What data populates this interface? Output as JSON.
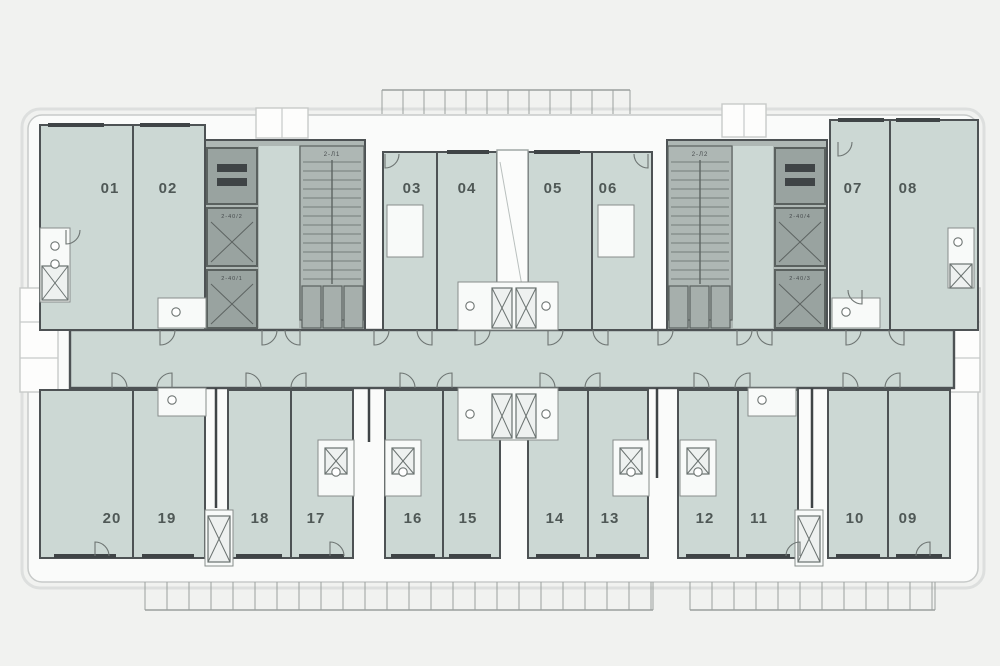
{
  "plan": {
    "name": "residential-floor-plan",
    "canvas": {
      "w": 1000,
      "h": 666
    },
    "colors": {
      "bg": "#f1f2f0",
      "paper": "#fafbfa",
      "outline": "#c7cac9",
      "trim": "#dddfde",
      "room": "#ccd8d4",
      "wall": "#4d5254",
      "core": "#aeb7b4",
      "coreCell": "#99a3a0",
      "coreEdge": "#5a615f",
      "dark": "#3f4446",
      "fixture": "#6d7472",
      "pod": "#f8faf9",
      "tick": "#9aa09e",
      "label": "#4f5856",
      "tinyLabel": "#454a4c"
    },
    "units_top": [
      {
        "label": "01",
        "x": 40,
        "y": 125,
        "w": 93,
        "h": 205,
        "lx": 110,
        "ly": 193
      },
      {
        "label": "02",
        "x": 133,
        "y": 125,
        "w": 72,
        "h": 205,
        "lx": 168,
        "ly": 193
      },
      {
        "label": "03",
        "x": 383,
        "y": 152,
        "w": 54,
        "h": 178,
        "lx": 412,
        "ly": 193
      },
      {
        "label": "04",
        "x": 437,
        "y": 152,
        "w": 60,
        "h": 178,
        "lx": 467,
        "ly": 193
      },
      {
        "label": "05",
        "x": 528,
        "y": 152,
        "w": 64,
        "h": 178,
        "lx": 553,
        "ly": 193
      },
      {
        "label": "06",
        "x": 592,
        "y": 152,
        "w": 60,
        "h": 178,
        "lx": 608,
        "ly": 193
      },
      {
        "label": "07",
        "x": 830,
        "y": 120,
        "w": 60,
        "h": 210,
        "lx": 853,
        "ly": 193
      },
      {
        "label": "08",
        "x": 890,
        "y": 120,
        "w": 88,
        "h": 210,
        "lx": 908,
        "ly": 193
      }
    ],
    "units_bottom": [
      {
        "label": "20",
        "x": 40,
        "y": 390,
        "w": 93,
        "h": 168,
        "lx": 112,
        "ly": 523
      },
      {
        "label": "19",
        "x": 133,
        "y": 390,
        "w": 72,
        "h": 168,
        "lx": 167,
        "ly": 523
      },
      {
        "label": "18",
        "x": 228,
        "y": 390,
        "w": 63,
        "h": 168,
        "lx": 260,
        "ly": 523
      },
      {
        "label": "17",
        "x": 291,
        "y": 390,
        "w": 62,
        "h": 168,
        "lx": 316,
        "ly": 523
      },
      {
        "label": "16",
        "x": 385,
        "y": 390,
        "w": 58,
        "h": 168,
        "lx": 413,
        "ly": 523
      },
      {
        "label": "15",
        "x": 443,
        "y": 390,
        "w": 57,
        "h": 168,
        "lx": 468,
        "ly": 523
      },
      {
        "label": "14",
        "x": 528,
        "y": 390,
        "w": 60,
        "h": 168,
        "lx": 555,
        "ly": 523
      },
      {
        "label": "13",
        "x": 588,
        "y": 390,
        "w": 60,
        "h": 168,
        "lx": 610,
        "ly": 523
      },
      {
        "label": "12",
        "x": 678,
        "y": 390,
        "w": 60,
        "h": 168,
        "lx": 705,
        "ly": 523
      },
      {
        "label": "11",
        "x": 738,
        "y": 390,
        "w": 60,
        "h": 168,
        "lx": 759,
        "ly": 523
      },
      {
        "label": "10",
        "x": 828,
        "y": 390,
        "w": 60,
        "h": 168,
        "lx": 855,
        "ly": 523
      },
      {
        "label": "09",
        "x": 888,
        "y": 390,
        "w": 62,
        "h": 168,
        "lx": 908,
        "ly": 523
      }
    ],
    "corridor": {
      "x": 70,
      "y": 330,
      "w": 884,
      "h": 58
    },
    "shaft": {
      "x": 497,
      "y": 150,
      "w": 31,
      "h": 146
    },
    "cores": [
      {
        "x": 205,
        "y": 140,
        "w": 160,
        "h": 190,
        "lobby": [
          259,
          146,
          40,
          182
        ],
        "stair": {
          "x": 300,
          "y": 146,
          "w": 64,
          "h": 174,
          "label": "2-Л1"
        },
        "cells": [
          {
            "x": 207,
            "y": 148,
            "w": 50,
            "h": 56,
            "type": "machine",
            "label": ""
          },
          {
            "x": 207,
            "y": 208,
            "w": 50,
            "h": 58,
            "type": "lift",
            "label": "2-40/2"
          },
          {
            "x": 207,
            "y": 270,
            "w": 50,
            "h": 58,
            "type": "lift",
            "label": "2-40/1"
          }
        ],
        "subcells": [
          [
            302,
            286,
            19,
            42
          ],
          [
            323,
            286,
            19,
            42
          ],
          [
            344,
            286,
            19,
            42
          ]
        ]
      },
      {
        "x": 667,
        "y": 140,
        "w": 160,
        "h": 190,
        "lobby": [
          733,
          146,
          40,
          182
        ],
        "stair": {
          "x": 668,
          "y": 146,
          "w": 64,
          "h": 174,
          "label": "2-Л2"
        },
        "cells": [
          {
            "x": 775,
            "y": 148,
            "w": 50,
            "h": 56,
            "type": "machine",
            "label": ""
          },
          {
            "x": 775,
            "y": 208,
            "w": 50,
            "h": 58,
            "type": "lift",
            "label": "2-40/4"
          },
          {
            "x": 775,
            "y": 270,
            "w": 50,
            "h": 58,
            "type": "lift",
            "label": "2-40/3"
          }
        ],
        "subcells": [
          [
            669,
            286,
            19,
            42
          ],
          [
            690,
            286,
            19,
            42
          ],
          [
            711,
            286,
            19,
            42
          ]
        ]
      }
    ],
    "balconies": {
      "rects": [
        [
          256,
          108,
          52,
          30
        ],
        [
          722,
          104,
          44,
          33
        ],
        [
          20,
          288,
          38,
          104
        ],
        [
          942,
          288,
          38,
          104
        ]
      ],
      "lines": [
        [
          20,
          322,
          58,
          322
        ],
        [
          20,
          358,
          58,
          358
        ],
        [
          942,
          322,
          980,
          322
        ],
        [
          942,
          358,
          980,
          358
        ],
        [
          282,
          108,
          282,
          138
        ],
        [
          744,
          104,
          744,
          137
        ]
      ]
    },
    "tickruns": [
      {
        "x1": 382,
        "x2": 630,
        "y": 90,
        "h": 24,
        "step": 21,
        "rail": "top"
      },
      {
        "x1": 145,
        "x2": 653,
        "y": 582,
        "h": 28,
        "step": 22,
        "rail": "bottom"
      },
      {
        "x1": 690,
        "x2": 935,
        "y": 582,
        "h": 28,
        "step": 22,
        "rail": "bottom"
      }
    ],
    "pods": [
      [
        40,
        228,
        30,
        74
      ],
      [
        387,
        205,
        36,
        52
      ],
      [
        598,
        205,
        36,
        52
      ],
      [
        948,
        228,
        26,
        60
      ],
      [
        458,
        282,
        100,
        48
      ],
      [
        458,
        388,
        100,
        52
      ],
      [
        318,
        440,
        36,
        56
      ],
      [
        385,
        440,
        36,
        56
      ],
      [
        613,
        440,
        36,
        56
      ],
      [
        680,
        440,
        36,
        56
      ],
      [
        158,
        298,
        48,
        30
      ],
      [
        832,
        298,
        48,
        30
      ],
      [
        158,
        388,
        48,
        28
      ],
      [
        748,
        388,
        48,
        28
      ],
      [
        205,
        510,
        28,
        56
      ],
      [
        795,
        510,
        28,
        56
      ]
    ],
    "xcells": [
      [
        42,
        266,
        26,
        34
      ],
      [
        950,
        264,
        22,
        24
      ],
      [
        492,
        288,
        20,
        40
      ],
      [
        516,
        288,
        20,
        40
      ],
      [
        492,
        394,
        20,
        44
      ],
      [
        516,
        394,
        20,
        44
      ],
      [
        325,
        448,
        22,
        26
      ],
      [
        392,
        448,
        22,
        26
      ],
      [
        620,
        448,
        22,
        26
      ],
      [
        687,
        448,
        22,
        26
      ],
      [
        208,
        516,
        22,
        46
      ],
      [
        798,
        516,
        22,
        46
      ]
    ],
    "stems": [
      [
        216,
        388,
        216,
        508
      ],
      [
        369,
        388,
        369,
        442
      ],
      [
        657,
        388,
        657,
        478
      ],
      [
        812,
        388,
        812,
        508
      ]
    ],
    "bars": [
      [
        48,
        125,
        56
      ],
      [
        140,
        125,
        50
      ],
      [
        447,
        152,
        42
      ],
      [
        534,
        152,
        46
      ],
      [
        838,
        120,
        46
      ],
      [
        896,
        120,
        44
      ],
      [
        54,
        556,
        62
      ],
      [
        142,
        556,
        52
      ],
      [
        236,
        556,
        46
      ],
      [
        299,
        556,
        45
      ],
      [
        391,
        556,
        44
      ],
      [
        449,
        556,
        42
      ],
      [
        536,
        556,
        44
      ],
      [
        596,
        556,
        44
      ],
      [
        686,
        556,
        44
      ],
      [
        746,
        556,
        44
      ],
      [
        836,
        556,
        44
      ],
      [
        896,
        556,
        46
      ]
    ],
    "circles": [
      [
        55,
        246
      ],
      [
        55,
        264
      ],
      [
        470,
        306
      ],
      [
        546,
        306
      ],
      [
        470,
        414
      ],
      [
        546,
        414
      ],
      [
        336,
        472
      ],
      [
        403,
        472
      ],
      [
        631,
        472
      ],
      [
        698,
        472
      ],
      [
        176,
        312
      ],
      [
        846,
        312
      ],
      [
        172,
        400
      ],
      [
        762,
        400
      ],
      [
        958,
        242
      ]
    ],
    "arcs": [
      [
        160,
        330,
        "dr"
      ],
      [
        262,
        330,
        "dr"
      ],
      [
        300,
        330,
        "dl"
      ],
      [
        374,
        330,
        "dr"
      ],
      [
        432,
        330,
        "dl"
      ],
      [
        475,
        330,
        "dr"
      ],
      [
        548,
        330,
        "dr"
      ],
      [
        608,
        330,
        "dl"
      ],
      [
        658,
        330,
        "dr"
      ],
      [
        737,
        330,
        "dr"
      ],
      [
        772,
        330,
        "dl"
      ],
      [
        846,
        330,
        "dr"
      ],
      [
        904,
        330,
        "dl"
      ],
      [
        112,
        388,
        "ur"
      ],
      [
        172,
        388,
        "ul"
      ],
      [
        246,
        388,
        "ur"
      ],
      [
        306,
        388,
        "ul"
      ],
      [
        400,
        388,
        "ur"
      ],
      [
        452,
        388,
        "ul"
      ],
      [
        540,
        388,
        "ur"
      ],
      [
        600,
        388,
        "ul"
      ],
      [
        694,
        388,
        "ur"
      ],
      [
        750,
        388,
        "ul"
      ],
      [
        843,
        388,
        "ur"
      ],
      [
        900,
        388,
        "ul"
      ],
      [
        66,
        230,
        "dr",
        14
      ],
      [
        385,
        154,
        "dr",
        14
      ],
      [
        648,
        154,
        "dl",
        14
      ],
      [
        838,
        142,
        "dr",
        14
      ],
      [
        862,
        290,
        "dl",
        14
      ],
      [
        330,
        556,
        "ur",
        14
      ],
      [
        800,
        556,
        "ul",
        14
      ],
      [
        95,
        556,
        "ur",
        14
      ],
      [
        930,
        556,
        "ul",
        14
      ]
    ]
  }
}
